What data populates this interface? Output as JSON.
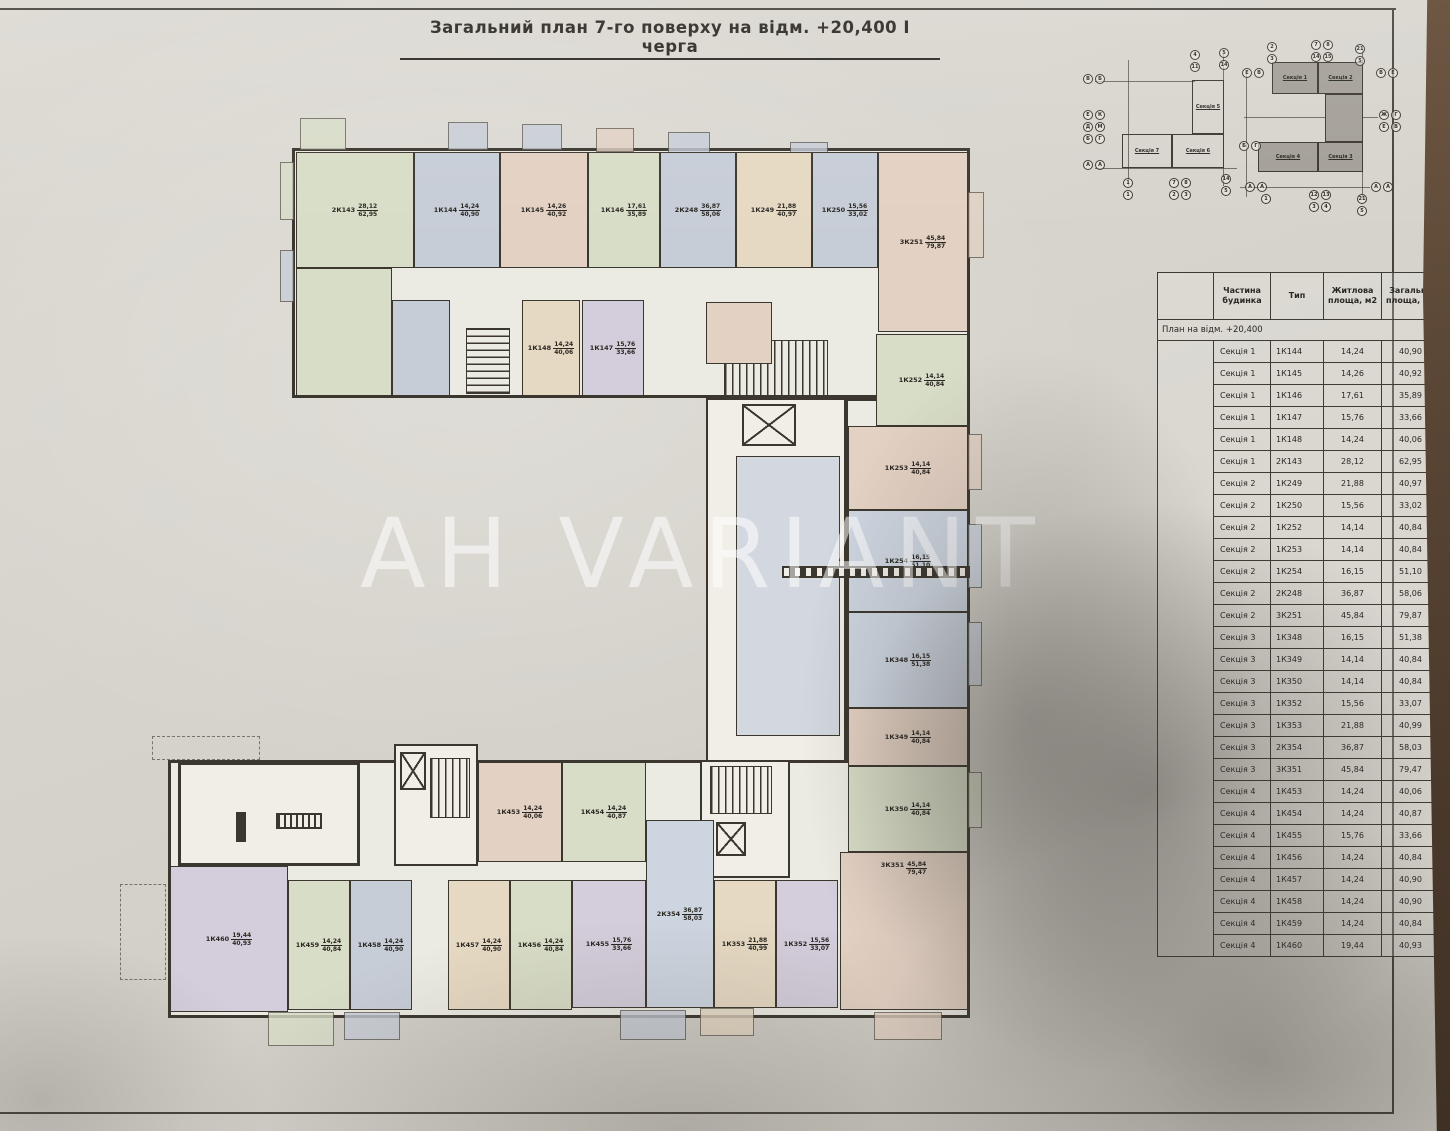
{
  "title": "Загальний план 7-го поверху на відм. +20,400 І черга",
  "watermark": "AH VARIANT",
  "key_plan": {
    "left_sections": [
      "Секція 5",
      "Секція 7",
      "Секція 6"
    ],
    "right_sections": [
      "Секція 1",
      "Секція 2",
      "Секція 4",
      "Секція 3"
    ],
    "bubbles": [
      [
        "В",
        1083,
        74
      ],
      [
        "Б",
        1095,
        74
      ],
      [
        "Е",
        1083,
        110
      ],
      [
        "К",
        1095,
        110
      ],
      [
        "Д",
        1083,
        122
      ],
      [
        "М",
        1095,
        122
      ],
      [
        "Б",
        1083,
        134
      ],
      [
        "Г",
        1095,
        134
      ],
      [
        "А",
        1083,
        160
      ],
      [
        "А",
        1095,
        160
      ],
      [
        "4",
        1190,
        50
      ],
      [
        "11",
        1190,
        62
      ],
      [
        "5",
        1219,
        48
      ],
      [
        "14",
        1219,
        60
      ],
      [
        "1",
        1123,
        178
      ],
      [
        "1",
        1123,
        190
      ],
      [
        "7",
        1169,
        178
      ],
      [
        "8",
        1181,
        178
      ],
      [
        "2",
        1169,
        190
      ],
      [
        "3",
        1181,
        190
      ],
      [
        "14",
        1221,
        174
      ],
      [
        "5",
        1221,
        186
      ],
      [
        "2",
        1267,
        42
      ],
      [
        "3",
        1267,
        54
      ],
      [
        "7",
        1311,
        40
      ],
      [
        "8",
        1323,
        40
      ],
      [
        "14",
        1311,
        52
      ],
      [
        "15",
        1323,
        52
      ],
      [
        "21",
        1355,
        44
      ],
      [
        "5",
        1355,
        56
      ],
      [
        "Е",
        1242,
        68
      ],
      [
        "В",
        1254,
        68
      ],
      [
        "Б",
        1239,
        141
      ],
      [
        "Г",
        1251,
        141
      ],
      [
        "А",
        1245,
        182
      ],
      [
        "А",
        1257,
        182
      ],
      [
        "В",
        1376,
        68
      ],
      [
        "Е",
        1388,
        68
      ],
      [
        "Ж",
        1379,
        110
      ],
      [
        "Г",
        1391,
        110
      ],
      [
        "Е",
        1379,
        122
      ],
      [
        "В",
        1391,
        122
      ],
      [
        "А",
        1371,
        182
      ],
      [
        "А",
        1383,
        182
      ],
      [
        "1",
        1261,
        194
      ],
      [
        "12",
        1309,
        190
      ],
      [
        "13",
        1321,
        190
      ],
      [
        "3",
        1309,
        202
      ],
      [
        "4",
        1321,
        202
      ],
      [
        "21",
        1357,
        194
      ],
      [
        "5",
        1357,
        206
      ]
    ]
  },
  "table": {
    "headers": [
      "",
      "Частина будинка",
      "Тип",
      "Житлова площа, м2",
      "Загальна площа, м2"
    ],
    "group_row": "План на відм. +20,400",
    "rows": [
      [
        "Секція 1",
        "1К144",
        "14,24",
        "40,90"
      ],
      [
        "Секція 1",
        "1К145",
        "14,26",
        "40,92"
      ],
      [
        "Секція 1",
        "1К146",
        "17,61",
        "35,89"
      ],
      [
        "Секція 1",
        "1К147",
        "15,76",
        "33,66"
      ],
      [
        "Секція 1",
        "1К148",
        "14,24",
        "40,06"
      ],
      [
        "Секція 1",
        "2К143",
        "28,12",
        "62,95"
      ],
      [
        "Секція 2",
        "1К249",
        "21,88",
        "40,97"
      ],
      [
        "Секція 2",
        "1К250",
        "15,56",
        "33,02"
      ],
      [
        "Секція 2",
        "1К252",
        "14,14",
        "40,84"
      ],
      [
        "Секція 2",
        "1К253",
        "14,14",
        "40,84"
      ],
      [
        "Секція 2",
        "1К254",
        "16,15",
        "51,10"
      ],
      [
        "Секція 2",
        "2К248",
        "36,87",
        "58,06"
      ],
      [
        "Секція 2",
        "3К251",
        "45,84",
        "79,87"
      ],
      [
        "Секція 3",
        "1К348",
        "16,15",
        "51,38"
      ],
      [
        "Секція 3",
        "1К349",
        "14,14",
        "40,84"
      ],
      [
        "Секція 3",
        "1К350",
        "14,14",
        "40,84"
      ],
      [
        "Секція 3",
        "1К352",
        "15,56",
        "33,07"
      ],
      [
        "Секція 3",
        "1К353",
        "21,88",
        "40,99"
      ],
      [
        "Секція 3",
        "2К354",
        "36,87",
        "58,03"
      ],
      [
        "Секція 3",
        "3К351",
        "45,84",
        "79,47"
      ],
      [
        "Секція 4",
        "1К453",
        "14,24",
        "40,06"
      ],
      [
        "Секція 4",
        "1К454",
        "14,24",
        "40,87"
      ],
      [
        "Секція 4",
        "1К455",
        "15,76",
        "33,66"
      ],
      [
        "Секція 4",
        "1К456",
        "14,24",
        "40,84"
      ],
      [
        "Секція 4",
        "1К457",
        "14,24",
        "40,90"
      ],
      [
        "Секція 4",
        "1К458",
        "14,24",
        "40,90"
      ],
      [
        "Секція 4",
        "1К459",
        "14,24",
        "40,84"
      ],
      [
        "Секція 4",
        "1К460",
        "19,44",
        "40,93"
      ]
    ]
  },
  "plan": {
    "colors": {
      "green": "#d8ddc7",
      "bluegray": "#c7cdd7",
      "rose": "#e3d1c3",
      "beige": "#e6d9c3",
      "blue": "#cdd5e0",
      "lavender": "#d4cedc",
      "white": "#f0eee6"
    },
    "apartments": [
      {
        "code": "2К143",
        "living": "28,12",
        "total": "62,95",
        "color": "green",
        "x": 296,
        "y": 152,
        "w": 118,
        "h": 116
      },
      {
        "code": "1К144",
        "living": "14,24",
        "total": "40,90",
        "color": "bluegray",
        "x": 414,
        "y": 152,
        "w": 86,
        "h": 116
      },
      {
        "code": "1К145",
        "living": "14,26",
        "total": "40,92",
        "color": "rose",
        "x": 500,
        "y": 152,
        "w": 88,
        "h": 116
      },
      {
        "code": "1К146",
        "living": "17,61",
        "total": "35,89",
        "color": "green",
        "x": 588,
        "y": 152,
        "w": 72,
        "h": 116
      },
      {
        "code": "2К248",
        "living": "36,87",
        "total": "58,06",
        "color": "bluegray",
        "x": 660,
        "y": 152,
        "w": 76,
        "h": 116
      },
      {
        "code": "1К249",
        "living": "21,88",
        "total": "40,97",
        "color": "beige",
        "x": 736,
        "y": 152,
        "w": 76,
        "h": 116
      },
      {
        "code": "1К250",
        "living": "15,56",
        "total": "33,02",
        "color": "bluegray",
        "x": 812,
        "y": 152,
        "w": 66,
        "h": 116
      },
      {
        "code": "3К251",
        "living": "45,84",
        "total": "79,87",
        "color": "rose",
        "x": 878,
        "y": 152,
        "w": 90,
        "h": 180
      },
      {
        "color": "green",
        "x": 296,
        "y": 268,
        "w": 96,
        "h": 128
      },
      {
        "color": "bluegray",
        "x": 392,
        "y": 300,
        "w": 58,
        "h": 96
      },
      {
        "code": "1К148",
        "living": "14,24",
        "total": "40,06",
        "color": "beige",
        "x": 522,
        "y": 300,
        "w": 58,
        "h": 96
      },
      {
        "code": "1К147",
        "living": "15,76",
        "total": "33,66",
        "color": "lavender",
        "x": 582,
        "y": 300,
        "w": 62,
        "h": 96
      },
      {
        "color": "rose",
        "x": 706,
        "y": 302,
        "w": 66,
        "h": 62
      },
      {
        "code": "1К252",
        "living": "14,14",
        "total": "40,84",
        "color": "green",
        "x": 876,
        "y": 334,
        "w": 92,
        "h": 92
      },
      {
        "code": "1К253",
        "living": "14,14",
        "total": "40,84",
        "color": "rose",
        "x": 848,
        "y": 426,
        "w": 120,
        "h": 84
      },
      {
        "code": "1К254",
        "living": "16,15",
        "total": "51,10",
        "color": "blue",
        "x": 848,
        "y": 510,
        "w": 120,
        "h": 102
      },
      {
        "code": "1К348",
        "living": "16,15",
        "total": "51,38",
        "color": "blue",
        "x": 848,
        "y": 612,
        "w": 120,
        "h": 96
      },
      {
        "code": "1К349",
        "living": "14,14",
        "total": "40,84",
        "color": "rose",
        "x": 848,
        "y": 708,
        "w": 120,
        "h": 58
      },
      {
        "code": "1К350",
        "living": "14,14",
        "total": "40,84",
        "color": "green",
        "x": 848,
        "y": 766,
        "w": 120,
        "h": 86
      },
      {
        "code": "3К351",
        "living": "45,84",
        "total": "79,47",
        "color": "rose",
        "x": 840,
        "y": 852,
        "w": 128,
        "h": 158,
        "lp": "top"
      },
      {
        "color": "white",
        "x": 178,
        "y": 762,
        "w": 182,
        "h": 104,
        "thick": true
      },
      {
        "code": "1К453",
        "living": "14,24",
        "total": "40,06",
        "color": "rose",
        "x": 478,
        "y": 762,
        "w": 84,
        "h": 100
      },
      {
        "code": "1К454",
        "living": "14,24",
        "total": "40,87",
        "color": "green",
        "x": 562,
        "y": 762,
        "w": 84,
        "h": 100
      },
      {
        "code": "2К354",
        "living": "36,87",
        "total": "58,03",
        "color": "blue",
        "x": 646,
        "y": 820,
        "w": 68,
        "h": 188
      },
      {
        "code": "1К460",
        "living": "19,44",
        "total": "40,93",
        "color": "lavender",
        "x": 170,
        "y": 866,
        "w": 118,
        "h": 146
      },
      {
        "code": "1К459",
        "living": "14,24",
        "total": "40,84",
        "color": "green",
        "x": 288,
        "y": 880,
        "w": 62,
        "h": 130
      },
      {
        "code": "1К458",
        "living": "14,24",
        "total": "40,90",
        "color": "bluegray",
        "x": 350,
        "y": 880,
        "w": 62,
        "h": 130
      },
      {
        "code": "1К457",
        "living": "14,24",
        "total": "40,90",
        "color": "beige",
        "x": 448,
        "y": 880,
        "w": 62,
        "h": 130
      },
      {
        "code": "1К456",
        "living": "14,24",
        "total": "40,84",
        "color": "green",
        "x": 510,
        "y": 880,
        "w": 62,
        "h": 130
      },
      {
        "code": "1К455",
        "living": "15,76",
        "total": "33,66",
        "color": "lavender",
        "x": 572,
        "y": 880,
        "w": 74,
        "h": 128
      },
      {
        "code": "1К353",
        "living": "21,88",
        "total": "40,99",
        "color": "beige",
        "x": 714,
        "y": 880,
        "w": 62,
        "h": 128
      },
      {
        "code": "1К352",
        "living": "15,56",
        "total": "33,07",
        "color": "lavender",
        "x": 776,
        "y": 880,
        "w": 62,
        "h": 128
      }
    ],
    "balconies": [
      [
        300,
        118,
        46,
        32,
        "green"
      ],
      [
        448,
        122,
        40,
        28,
        "bluegray"
      ],
      [
        522,
        124,
        40,
        26,
        "bluegray"
      ],
      [
        596,
        128,
        38,
        24,
        "rose"
      ],
      [
        668,
        132,
        42,
        22,
        "bluegray"
      ],
      [
        790,
        142,
        38,
        20,
        "bluegray"
      ],
      [
        280,
        162,
        14,
        58,
        "green"
      ],
      [
        280,
        250,
        14,
        52,
        "bluegray"
      ],
      [
        968,
        192,
        16,
        66,
        "rose"
      ],
      [
        968,
        434,
        14,
        56,
        "rose"
      ],
      [
        968,
        524,
        14,
        64,
        "blue"
      ],
      [
        968,
        622,
        14,
        64,
        "blue"
      ],
      [
        968,
        772,
        14,
        56,
        "green"
      ],
      [
        268,
        1012,
        66,
        34,
        "green"
      ],
      [
        344,
        1012,
        56,
        28,
        "bluegray"
      ],
      [
        620,
        1010,
        66,
        30,
        "bluegray"
      ],
      [
        700,
        1008,
        54,
        28,
        "beige"
      ],
      [
        874,
        1012,
        68,
        28,
        "rose"
      ]
    ]
  }
}
